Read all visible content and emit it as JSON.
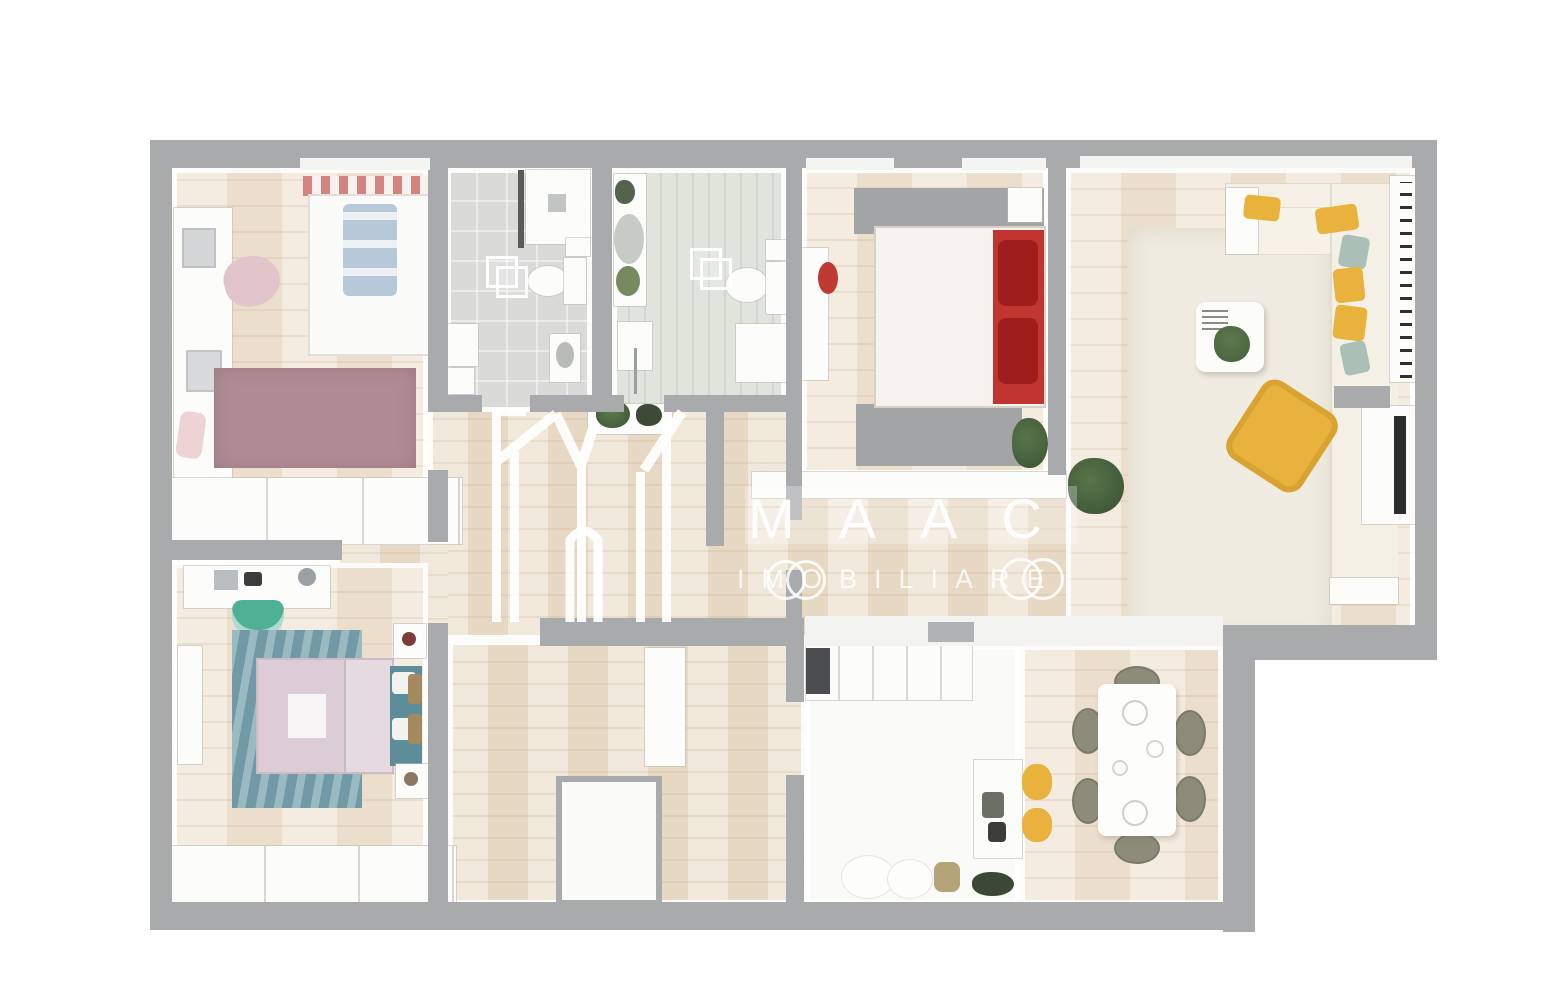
{
  "watermark": {
    "brand": "MAAC",
    "brand_sub": "IMOBILIARE",
    "monogram_icon": "maac-monogram-icon",
    "photo_icon": "photo-frame-icon",
    "ring_icon": "double-ring-ornament-icon"
  },
  "palette": {
    "background": "#ffffff",
    "wall": "#a8aaac",
    "wall_light": "#f3f4f2",
    "wood_floor": "#f0e6d7",
    "hall_floor": "#ebdfcc",
    "tile_floor": "#dadbd9",
    "tile_green_floor": "#e0e4dc",
    "white_floor": "#fafaf9",
    "rug_mauve": "#b08d95",
    "rug_teal": "#7ea6b1",
    "rug_grey": "#a2a4a5",
    "rug_cream": "#f0ece2",
    "bed_red": "#c13530",
    "pillow_red": "#9f1d1a",
    "duvet_pink": "#dcccd6",
    "headboard_teal": "#5e8d9a",
    "accent_yellow": "#e8b23d",
    "pillow_teal": "#aabfb6",
    "chair_green": "#4fb095",
    "chair_olive": "#8d8c7b",
    "plant_green": "#4c6342",
    "blanket_blue": "#b7c9d9",
    "canopy_pink": "#d4847f",
    "sofa_cream": "#f4f0e6",
    "dark_appliance": "#4b4d4f",
    "tv_black": "#2c2d2e",
    "watermark": "#ffffff"
  }
}
